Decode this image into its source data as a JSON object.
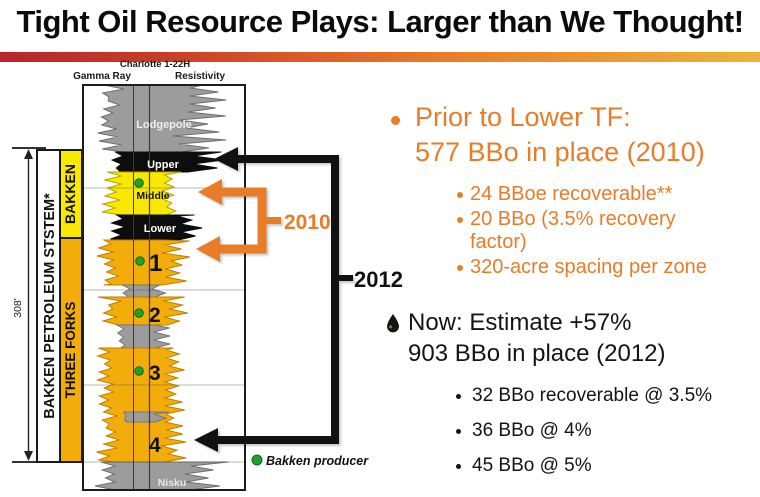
{
  "slide": {
    "title": "Tight Oil Resource Plays: Larger than We Thought!"
  },
  "colors": {
    "accent_orange": "#E87C28",
    "amber": "#F3AD0B",
    "bright_yellow": "#F9E800",
    "zone_gray": "#9C9C9C",
    "producer_green": "#1FA12B"
  },
  "well_log": {
    "well_name": "Charlotte 1-22H",
    "track_left": "Gamma Ray",
    "track_right": "Resistivity",
    "depth_span": "308'",
    "system_label": "BAKKEN PETROLEUM STSTEM*",
    "bakken_label": "BAKKEN",
    "three_forks_label": "THREE FORKS",
    "zones": [
      "Lodgepole",
      "Upper",
      "Middle",
      "Lower",
      "1",
      "2",
      "3",
      "4",
      "Nisku"
    ],
    "legend_producer": "Bakken producer",
    "callout_2010": "2010",
    "callout_2012": "2012"
  },
  "content": {
    "prior": {
      "line1": "Prior to Lower TF:",
      "line2": "577 BBo in place (2010)",
      "subs": [
        "24 BBoe recoverable**",
        "20 BBo (3.5% recovery factor)",
        "320-acre spacing per zone"
      ]
    },
    "now": {
      "line1": "Now: Estimate +57%",
      "line2": "903 BBo in place (2012)",
      "subs": [
        "32 BBo recoverable @ 3.5%",
        "36 BBo @ 4%",
        "45 BBo @ 5%"
      ]
    }
  }
}
